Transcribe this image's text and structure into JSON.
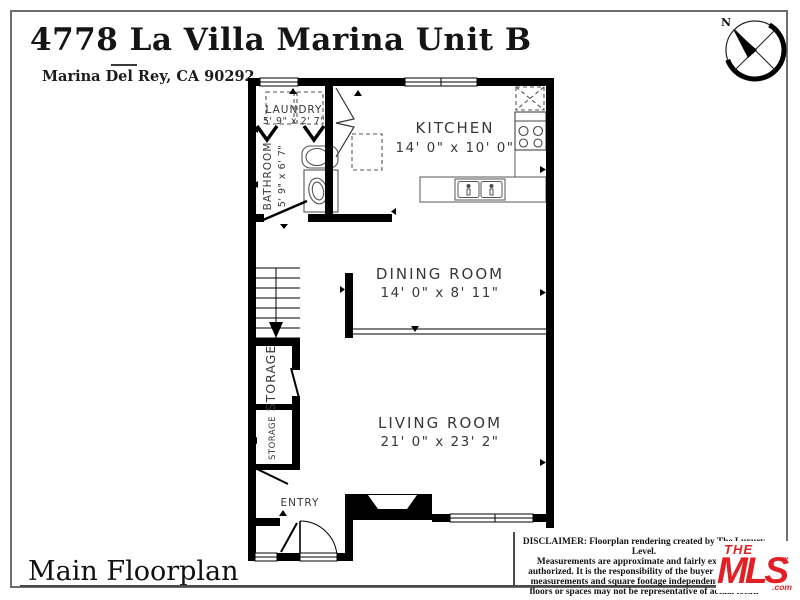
{
  "header": {
    "title": "4778 La Villa Marina Unit B",
    "subtitle": "Marina Del Rey, CA 90292"
  },
  "compass": {
    "north_label": "N"
  },
  "floorplan": {
    "rooms": {
      "laundry": {
        "name": "LAUNDRY",
        "dims": "5' 9\" x 2' 7\""
      },
      "bathroom": {
        "name": "BATHROOM",
        "dims": "5' 9\" x 6' 7\""
      },
      "kitchen": {
        "name": "KITCHEN",
        "dims": "14' 0\" x 10' 0\""
      },
      "dining_room": {
        "name": "DINING ROOM",
        "dims": "14' 0\" x 8' 11\""
      },
      "living_room": {
        "name": "LIVING ROOM",
        "dims": "21' 0\" x 23' 2\""
      },
      "storage_upper": {
        "name": "STORAGE"
      },
      "storage_lower": {
        "name": "STORAGE"
      },
      "entry": {
        "name": "ENTRY"
      }
    }
  },
  "footer": {
    "plan_label": "Main Floorplan"
  },
  "disclaimer": {
    "lines": [
      "DISCLAIMER: Floorplan rendering created by The Luxury Level.",
      "Measurements are approximate and fairly exact but r",
      "authorized. It is the responsibility of the buyer to verify th",
      "measurements and square footage independently. Multip",
      "floors or spaces may not be representative of actual locati"
    ]
  },
  "mls_logo": {
    "the": "THE",
    "mls": "MLS",
    "tm": "™",
    "com": ".com",
    "color": "#e31f26"
  },
  "colors": {
    "walls": "#000000",
    "labels": "#383838",
    "border": "#6e6e6e"
  }
}
